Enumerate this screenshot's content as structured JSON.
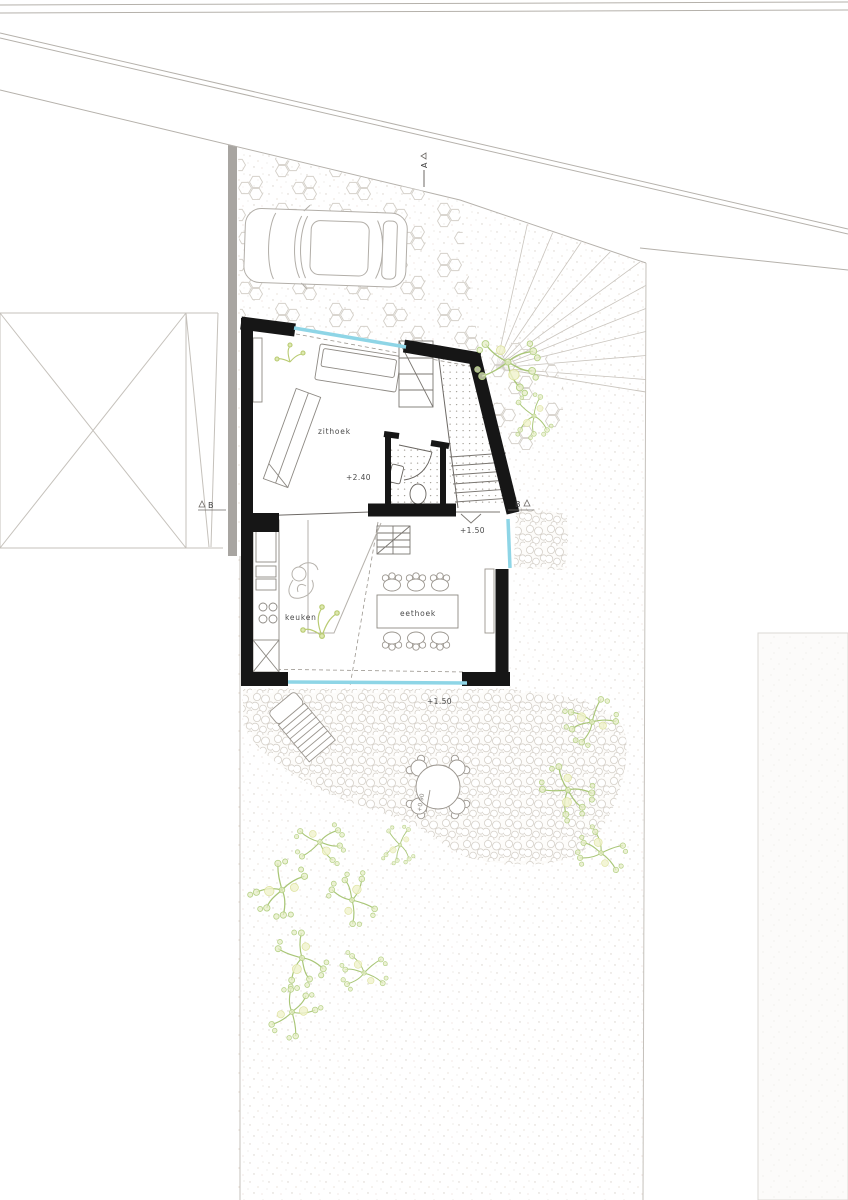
{
  "plan": {
    "rooms": {
      "living": {
        "label": "zithoek",
        "level": "+2.40"
      },
      "kitchen": {
        "label": "keuken"
      },
      "dining": {
        "label": "eethoek",
        "level": "+1.50"
      }
    },
    "site": {
      "terrace_level": "+1.50",
      "garden_level": "+0.90"
    },
    "sections": {
      "a": "A",
      "b": "B"
    },
    "colors": {
      "wall": "#161616",
      "window_glass": "#8ed5e6",
      "vegetation": "#a9c677",
      "hardscape_line": "#d4d0c9",
      "site_line": "#b5b1ab",
      "boundary_strip": "#a8a5a1"
    }
  }
}
